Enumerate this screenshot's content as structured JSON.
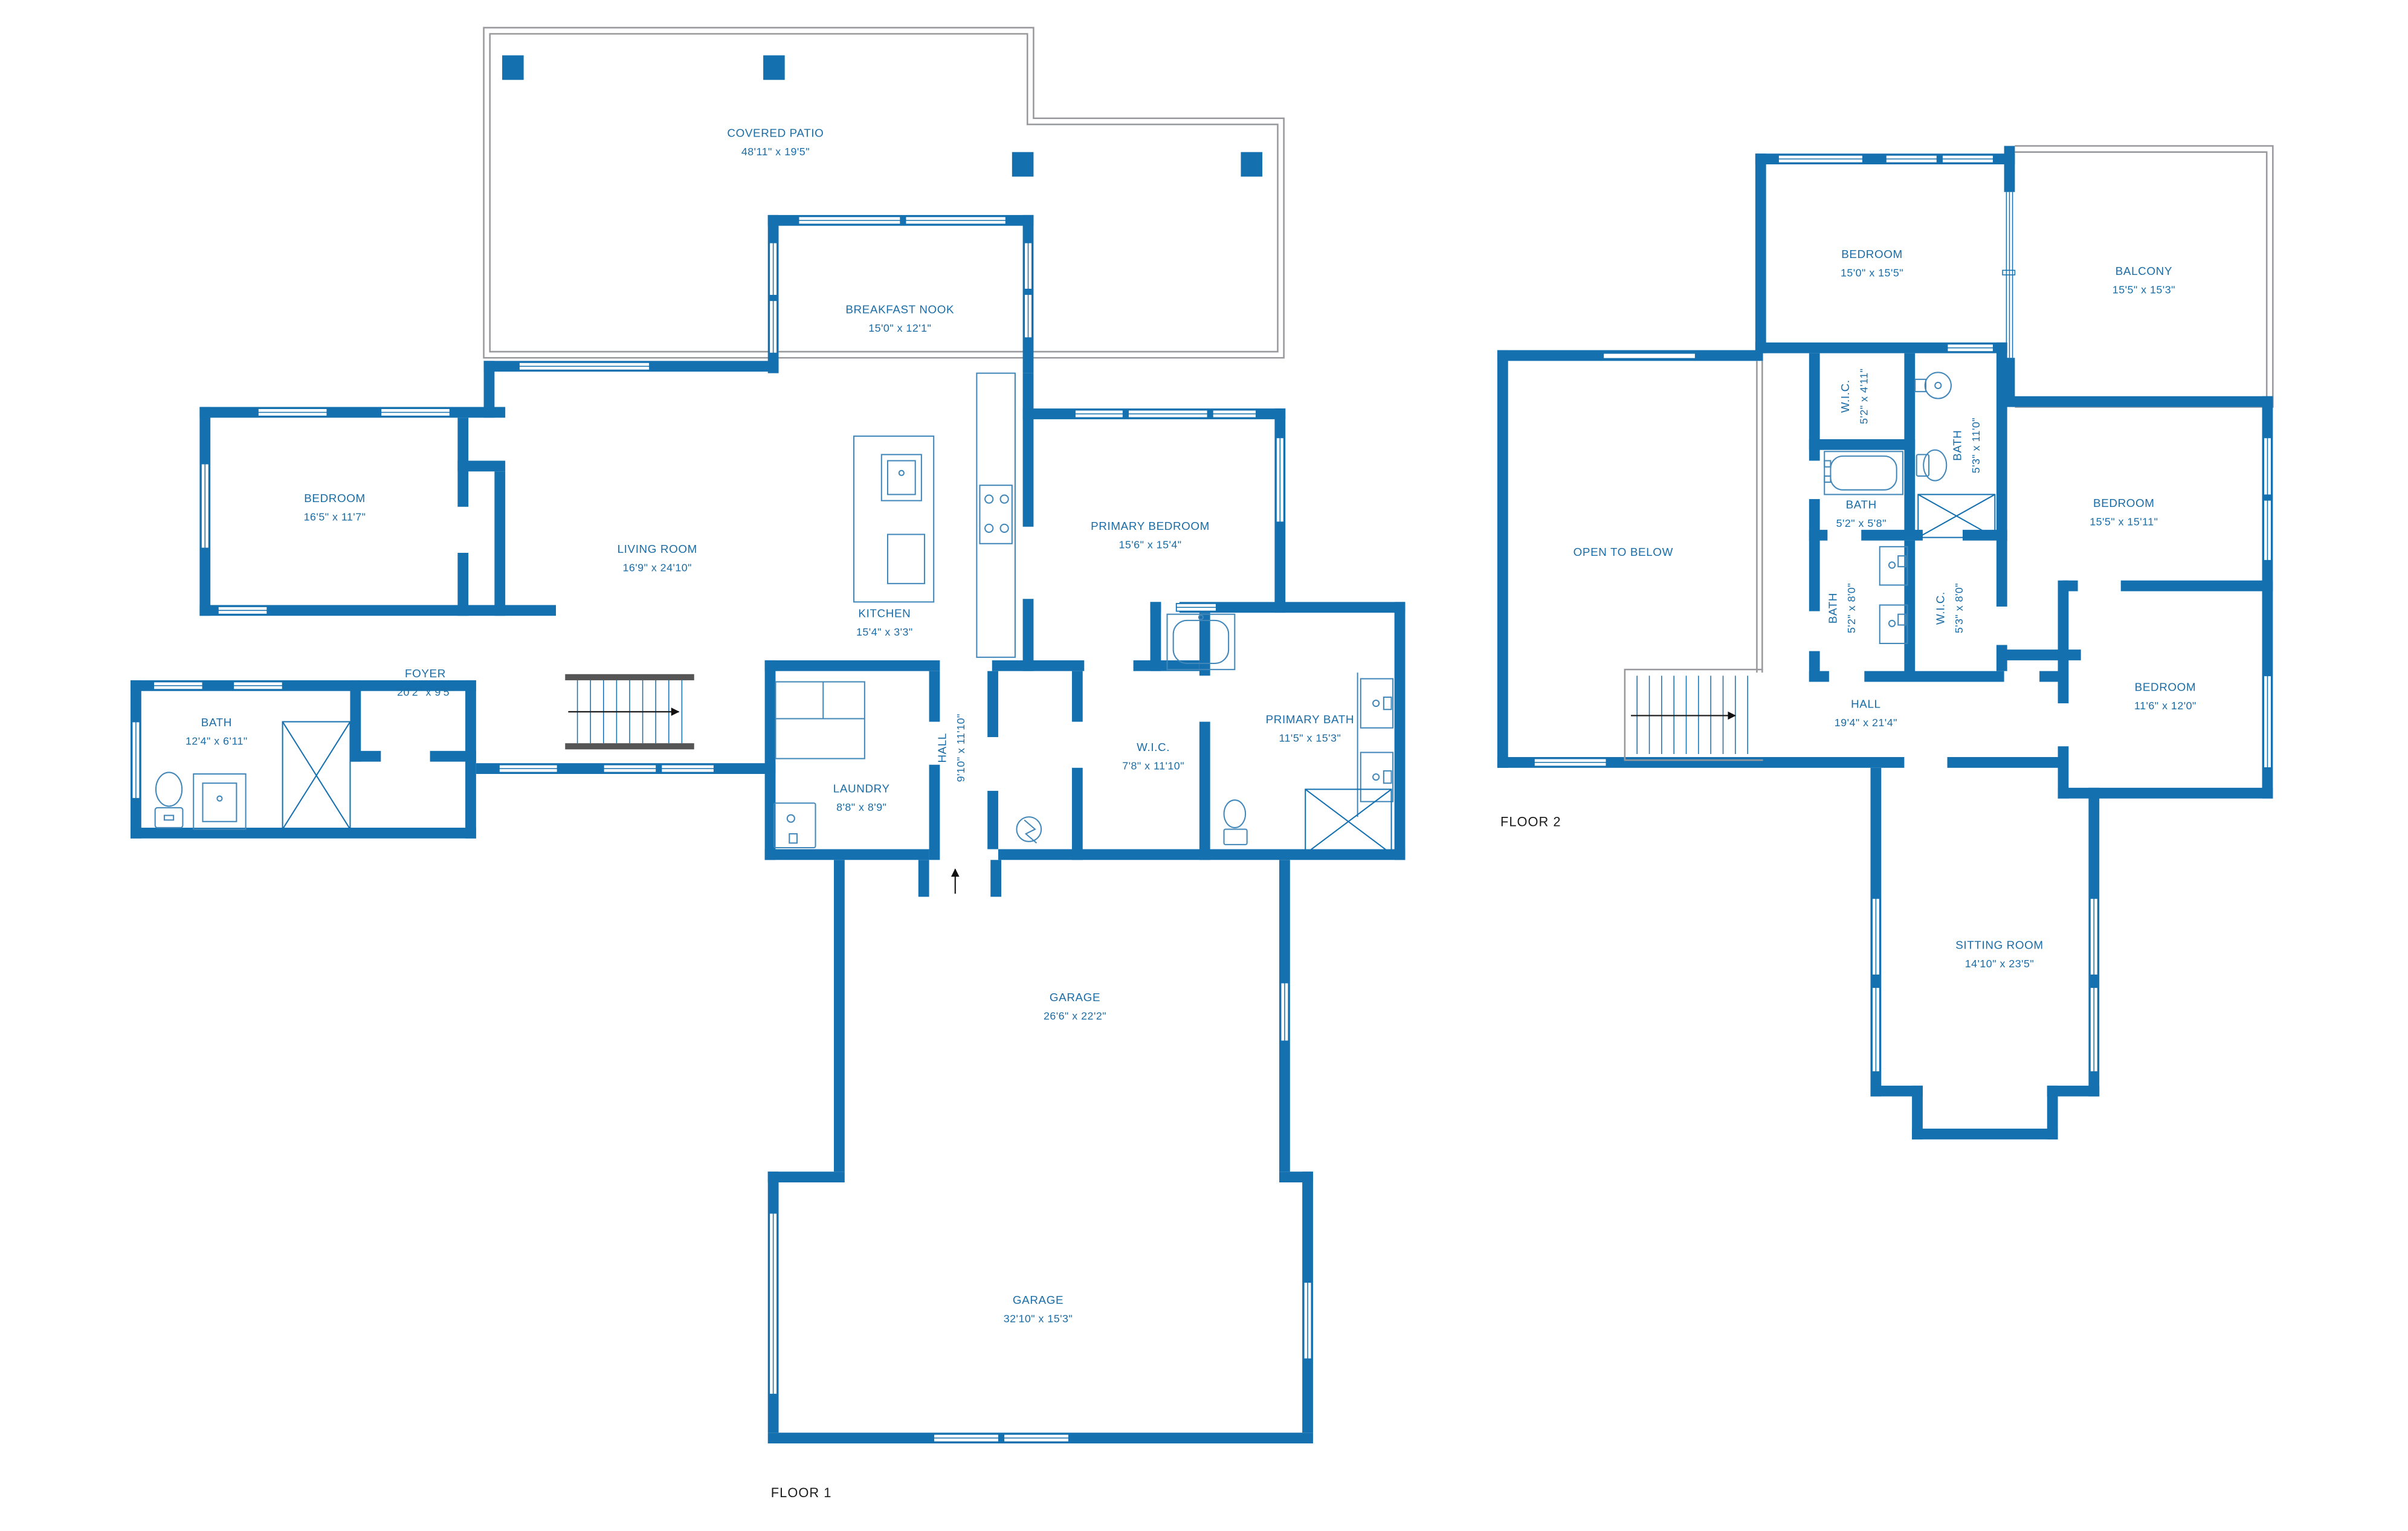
{
  "palette": {
    "wall_blue": "#1470af",
    "label_blue": "#1a6ca6",
    "outline_gray": "#98999d",
    "floor_label_color": "#1b1b1b",
    "background": "#ffffff"
  },
  "floor1": {
    "label": "FLOOR 1",
    "rooms": [
      {
        "name": "COVERED PATIO",
        "dims": "48'11\" x 19'5\""
      },
      {
        "name": "BREAKFAST NOOK",
        "dims": "15'0\" x 12'1\""
      },
      {
        "name": "BEDROOM",
        "dims": "16'5\" x 11'7\""
      },
      {
        "name": "LIVING ROOM",
        "dims": "16'9\" x 24'10\""
      },
      {
        "name": "KITCHEN",
        "dims": "15'4\" x 3'3\""
      },
      {
        "name": "PRIMARY BEDROOM",
        "dims": "15'6\" x 15'4\""
      },
      {
        "name": "FOYER",
        "dims": "20'2\" x 9'5\""
      },
      {
        "name": "BATH",
        "dims": "12'4\" x 6'11\""
      },
      {
        "name": "LAUNDRY",
        "dims": "8'8\" x 8'9\""
      },
      {
        "name": "HALL",
        "dims": "9'10\" x 11'10\""
      },
      {
        "name": "W.I.C.",
        "dims": "7'8\" x 11'10\""
      },
      {
        "name": "PRIMARY BATH",
        "dims": "11'5\" x 15'3\""
      },
      {
        "name": "GARAGE",
        "dims": "26'6\" x 22'2\""
      },
      {
        "name": "GARAGE",
        "dims": "32'10\" x 15'3\""
      }
    ]
  },
  "floor2": {
    "label": "FLOOR 2",
    "rooms": [
      {
        "name": "BEDROOM",
        "dims": "15'0\" x 15'5\""
      },
      {
        "name": "BALCONY",
        "dims": "15'5\" x 15'3\""
      },
      {
        "name": "W.I.C.",
        "dims": "5'2\" x 4'11\""
      },
      {
        "name": "BATH",
        "dims": "5'3\" x 11'0\""
      },
      {
        "name": "BATH",
        "dims": "5'2\" x 5'8\""
      },
      {
        "name": "OPEN TO BELOW",
        "dims": ""
      },
      {
        "name": "BEDROOM",
        "dims": "15'5\" x 15'11\""
      },
      {
        "name": "BATH",
        "dims": "5'2\" x 8'0\""
      },
      {
        "name": "W.I.C.",
        "dims": "5'3\" x 8'0\""
      },
      {
        "name": "HALL",
        "dims": "19'4\" x 21'4\""
      },
      {
        "name": "BEDROOM",
        "dims": "11'6\" x 12'0\""
      },
      {
        "name": "SITTING ROOM",
        "dims": "14'10\" x 23'5\""
      }
    ]
  }
}
